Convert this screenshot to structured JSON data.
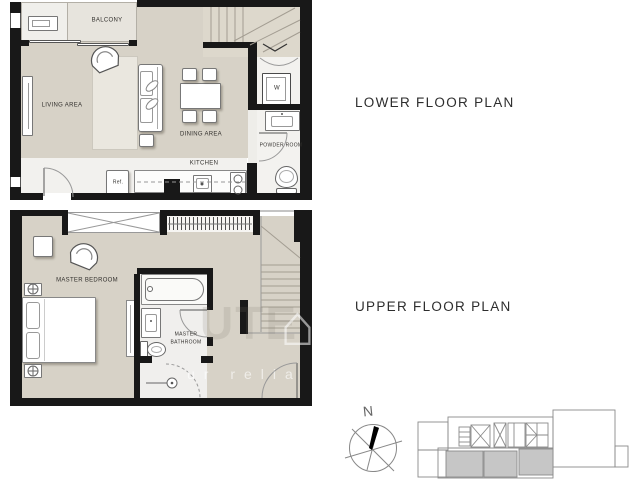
{
  "titles": {
    "lower": "LOWER FLOOR PLAN",
    "upper": "UPPER FLOOR PLAN"
  },
  "lower_plan": {
    "balcony": "BALCONY",
    "living": "LIVING AREA",
    "dining": "DINING AREA",
    "kitchen": "KITCHEN",
    "powder_room": "POWDER ROOM",
    "washer": "W",
    "fridge": "Ref."
  },
  "upper_plan": {
    "bedroom": "MASTER BEDROOM",
    "bathroom_line1": "MASTER",
    "bathroom_line2": "BATHROOM"
  },
  "compass": {
    "north": "N"
  },
  "watermark": {
    "fragment_large": "UTE",
    "house_glyph": "⌂",
    "fragment_small": "ur relia"
  },
  "colors": {
    "wall": "#181818",
    "floor": "#d7d2c7",
    "balcony_deck": "#e7e4dd",
    "service_white": "#f3f2ef",
    "kitchen_strip": "#f2f1ee",
    "stair_floor": "#ddd8cc",
    "bathroom_floor": "#f0efed",
    "keyplan_unit_highlight": "#c6c6c6"
  }
}
